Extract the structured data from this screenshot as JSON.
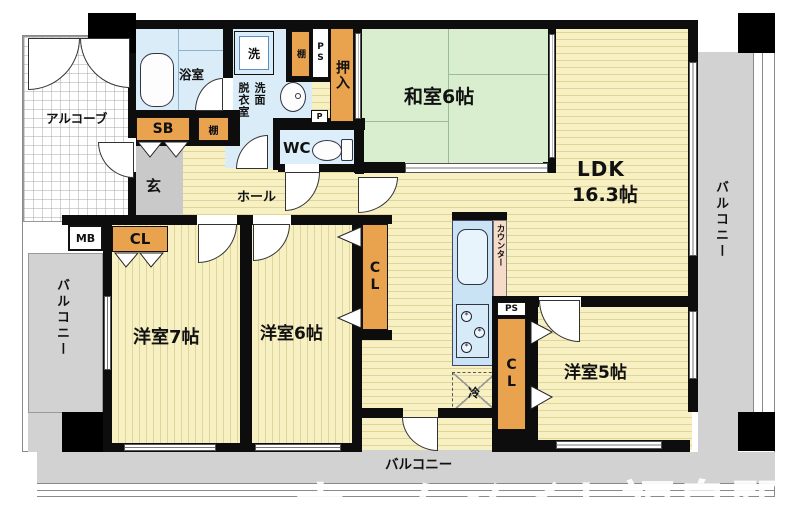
{
  "plan": {
    "type": "floor-plan",
    "rooms": {
      "washitsu": "和室6帖",
      "ldk_line1": "LDK",
      "ldk_line2": "16.3帖",
      "room7": "洋室7帖",
      "room6": "洋室6帖",
      "room5": "洋室5帖",
      "hall": "ホール",
      "genkan": "玄",
      "wc": "WC",
      "bath": "浴室",
      "senmen_col_right": "洗面",
      "senmen_col_left": "脱衣室",
      "alcove": "アルコーブ"
    },
    "storage": {
      "oshiire": "押入",
      "shoe_box": "SB",
      "shelf_top": "棚",
      "shelf_side": "棚",
      "cl_hall": "CL",
      "cl_mid": "CL",
      "cl_kitchen": "CL"
    },
    "utilities": {
      "ps_top": "PS",
      "ps_kitchen": "PS",
      "p": "P",
      "mb": "MB",
      "washer": "洗",
      "fridge": "冷",
      "counter": "カウンター"
    },
    "balconies": {
      "right": "バルコニー",
      "left": "バルコニー",
      "bottom": "バルコニー"
    },
    "watermark": "ホームメイト福島駅前",
    "colors": {
      "floor_yellow": "#f7f0c3",
      "tatami_green": "#d8eecf",
      "water_blue": "#d9ecf8",
      "closet_orange": "#e9a24e",
      "balcony_gray": "#d2d2d2",
      "counter_pink": "#f6dcc8",
      "wall_black": "#0d0d0d"
    }
  }
}
